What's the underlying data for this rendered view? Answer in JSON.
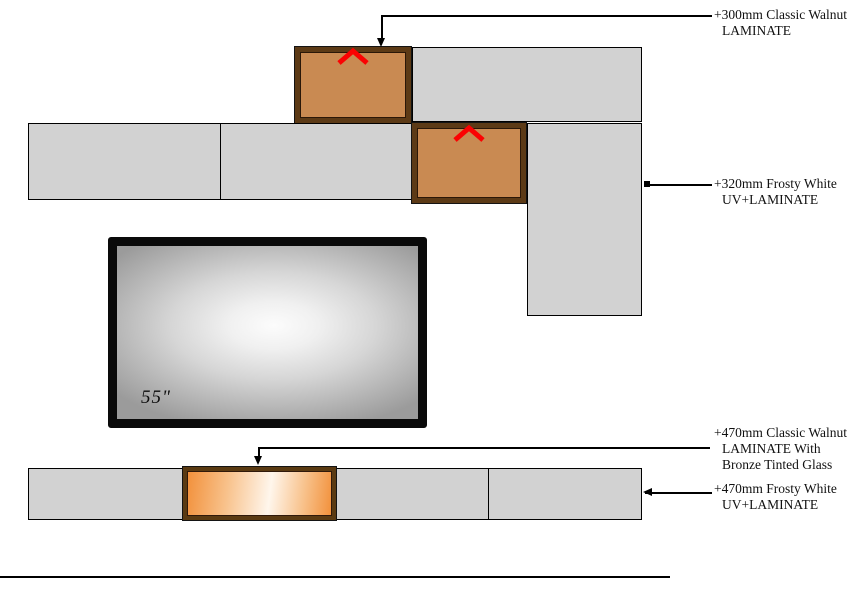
{
  "title": "TV unit elevation drawing",
  "colors": {
    "panel-gray": "#d2d2d2",
    "panel-border": "#000000",
    "walnut-frame": "#5c3a16",
    "walnut-fill": "#c98a52",
    "glass-frame": "#5a3a12",
    "glass-orange": "#f2913c",
    "glass-light": "#fff6ec",
    "chevron-red": "#fb0202",
    "tv-frame": "#0a0a0a",
    "line-color": "#000000"
  },
  "tv": {
    "size_label": "55\""
  },
  "annotations": [
    {
      "lines": [
        "+300mm Classic Walnut",
        "LAMINATE"
      ]
    },
    {
      "lines": [
        "+320mm Frosty White",
        "UV+LAMINATE"
      ]
    },
    {
      "lines": [
        "+470mm Classic Walnut",
        "LAMINATE With",
        "Bronze Tinted Glass"
      ]
    },
    {
      "lines": [
        "+470mm Frosty White",
        "UV+LAMINATE"
      ]
    }
  ]
}
